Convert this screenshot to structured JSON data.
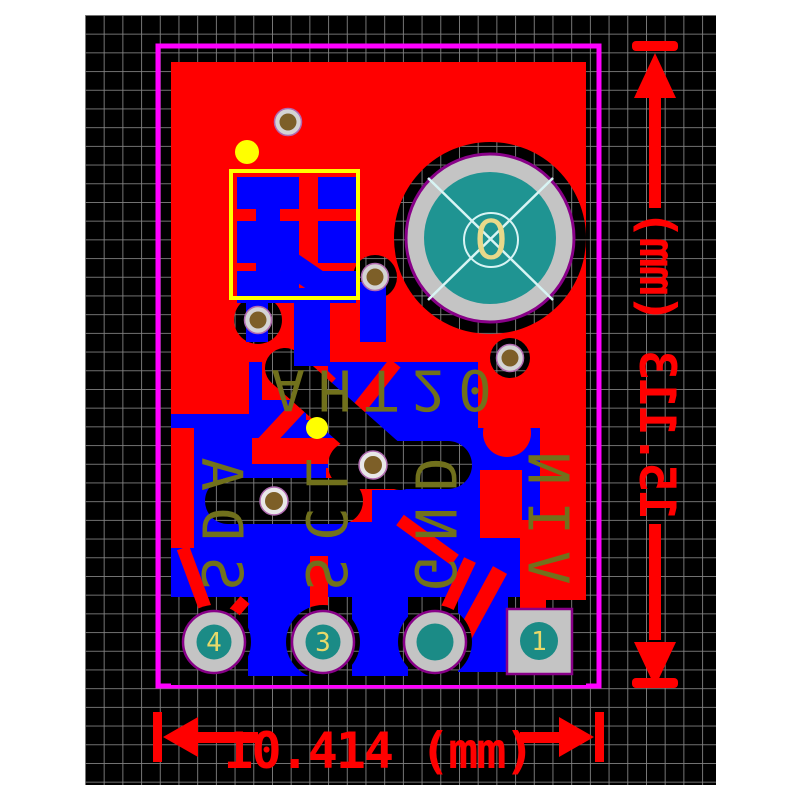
{
  "silkscreen": {
    "component_label": "AHT20",
    "pin_labels": [
      "SDA",
      "SCL",
      "GND",
      "VIN"
    ]
  },
  "pads": {
    "center_pad_label": "0",
    "pad4_number": "4",
    "pad3_number": "3",
    "pad1_number": "1"
  },
  "dimensions": {
    "horizontal_label": "10.414 (mm)",
    "vertical_label": "15.113 (mm)"
  },
  "colors": {
    "board_outline": "#ff00ff",
    "top_copper": "#ff0000",
    "bottom_copper": "#0000ff",
    "silkscreen": "#71711c",
    "courtyard": "#ffff00",
    "pad_ring": "#c4c4c4",
    "pad_center_teal": "#1b8b86",
    "drill_fill": "#7d5f28",
    "dimension_red": "#ff0000",
    "grid_line": "#828282",
    "background": "#000000"
  }
}
